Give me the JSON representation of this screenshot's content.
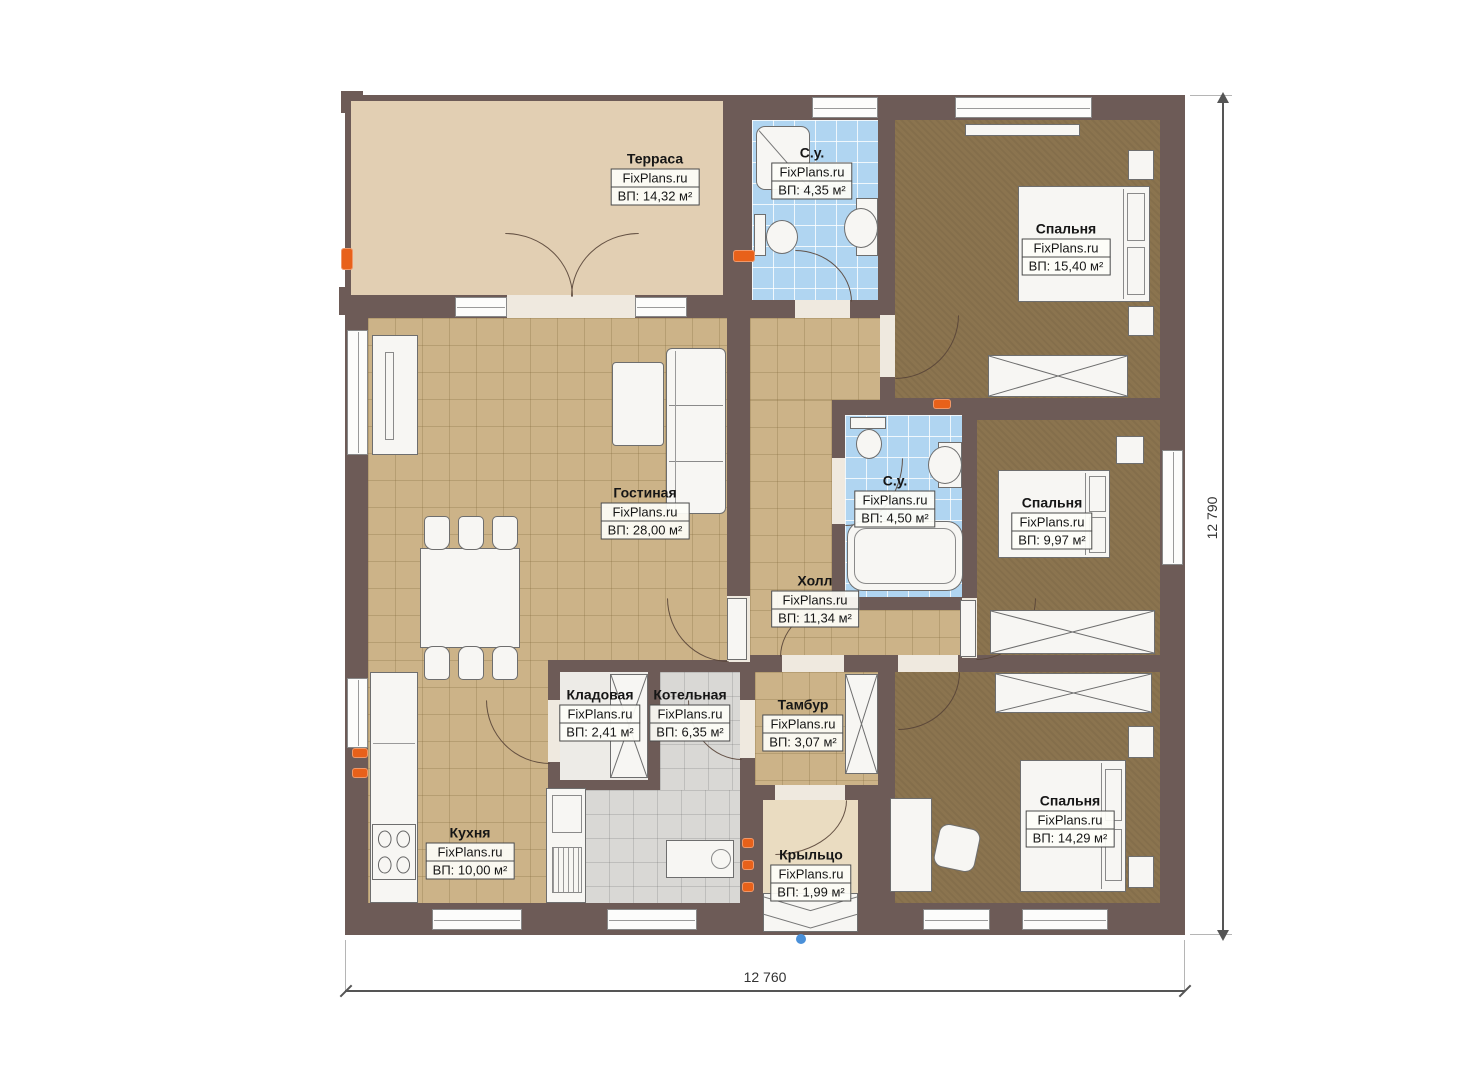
{
  "brand": "FixPlans.ru",
  "rooms": [
    {
      "name": "Терраса",
      "area": "ВП: 14,32 м²"
    },
    {
      "name": "С.у.",
      "area": "ВП: 4,35 м²"
    },
    {
      "name": "Спальня",
      "area": "ВП: 15,40 м²"
    },
    {
      "name": "Гостиная",
      "area": "ВП: 28,00 м²"
    },
    {
      "name": "С.у.",
      "area": "ВП: 4,50 м²"
    },
    {
      "name": "Спальня",
      "area": "ВП: 9,97 м²"
    },
    {
      "name": "Холл",
      "area": "ВП: 11,34 м²"
    },
    {
      "name": "Кладовая",
      "area": "ВП: 2,41 м²"
    },
    {
      "name": "Котельная",
      "area": "ВП: 6,35 м²"
    },
    {
      "name": "Тамбур",
      "area": "ВП: 3,07 м²"
    },
    {
      "name": "Кухня",
      "area": "ВП: 10,00 м²"
    },
    {
      "name": "Крыльцо",
      "area": "ВП: 1,99 м²"
    },
    {
      "name": "Спальня",
      "area": "ВП: 14,29 м²"
    }
  ],
  "dimensions": {
    "width": "12 760",
    "height": "12 790"
  },
  "colors": {
    "wall": "#6d5b57",
    "tile_tan": "#ccb388",
    "tile_blue": "#b0d5f1",
    "tile_gray": "#d9d8d5",
    "carpet": "#8b744f",
    "terrace": "#e2cfb3",
    "outlet_orange": "#e8611a",
    "entry_marker_blue": "#4a90d9"
  }
}
